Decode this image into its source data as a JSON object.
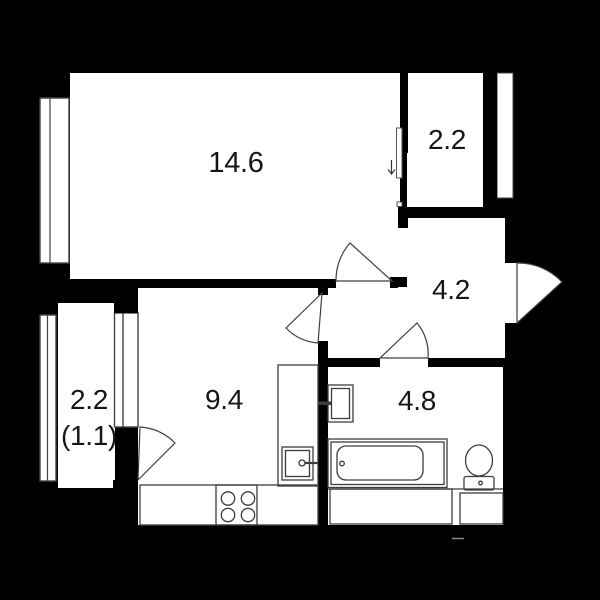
{
  "plan": {
    "type": "apartment-floor-plan",
    "background_color": "#000000",
    "floor_color": "#ffffff",
    "wall_color": "#000000",
    "fixture_outline_color": "#3d3d3d",
    "label_color": "#161616",
    "labels": {
      "living": "14.6",
      "wardrobe": "2.2",
      "hallway": "4.2",
      "kitchen": "9.4",
      "bathroom": "4.8",
      "balcony": "2.2",
      "balcony_reduced": "(1.1)"
    },
    "icons": {
      "sliding_door_arrow": "down-arrow"
    }
  }
}
